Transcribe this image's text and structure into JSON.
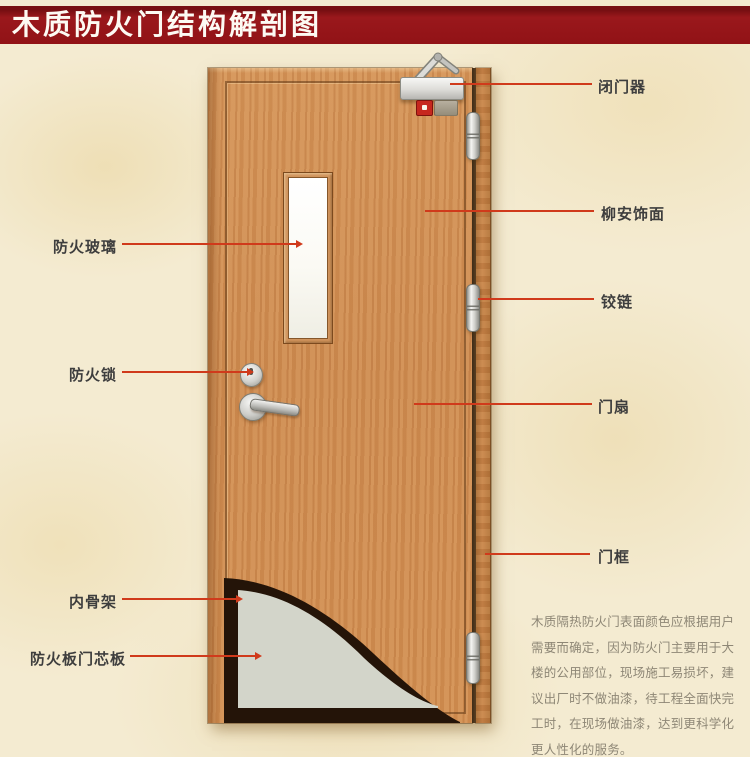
{
  "title": "木质防火门结构解剖图",
  "callouts": {
    "fire_glass": "防火玻璃",
    "fire_lock": "防火锁",
    "inner_skeleton": "内骨架",
    "fire_board_core": "防火板门芯板",
    "door_closer": "闭门器",
    "lauan_veneer": "柳安饰面",
    "hinge": "铰链",
    "door_leaf": "门扇",
    "door_frame": "门框"
  },
  "description": {
    "lines": [
      "木质隔热防火门表面颜色应根据用户",
      "需要而确定，因为防火门主要用于大",
      "楼的公用部位，现场施工易损坏，建",
      "议出厂时不做油漆，待工程全面快完",
      "工时，在现场做油漆，达到更科学化",
      "更人性化的服务。"
    ]
  },
  "colors": {
    "banner": "#96151a",
    "leader_line": "#d03a1b",
    "label_text": "#3e3e3e",
    "door_wood": "#d08f55",
    "frame_wood": "#bd7c42",
    "core_board": "#d3d5ca",
    "skeleton": "#241408",
    "background": "#f4ebd1",
    "description_text": "#8e8776"
  }
}
